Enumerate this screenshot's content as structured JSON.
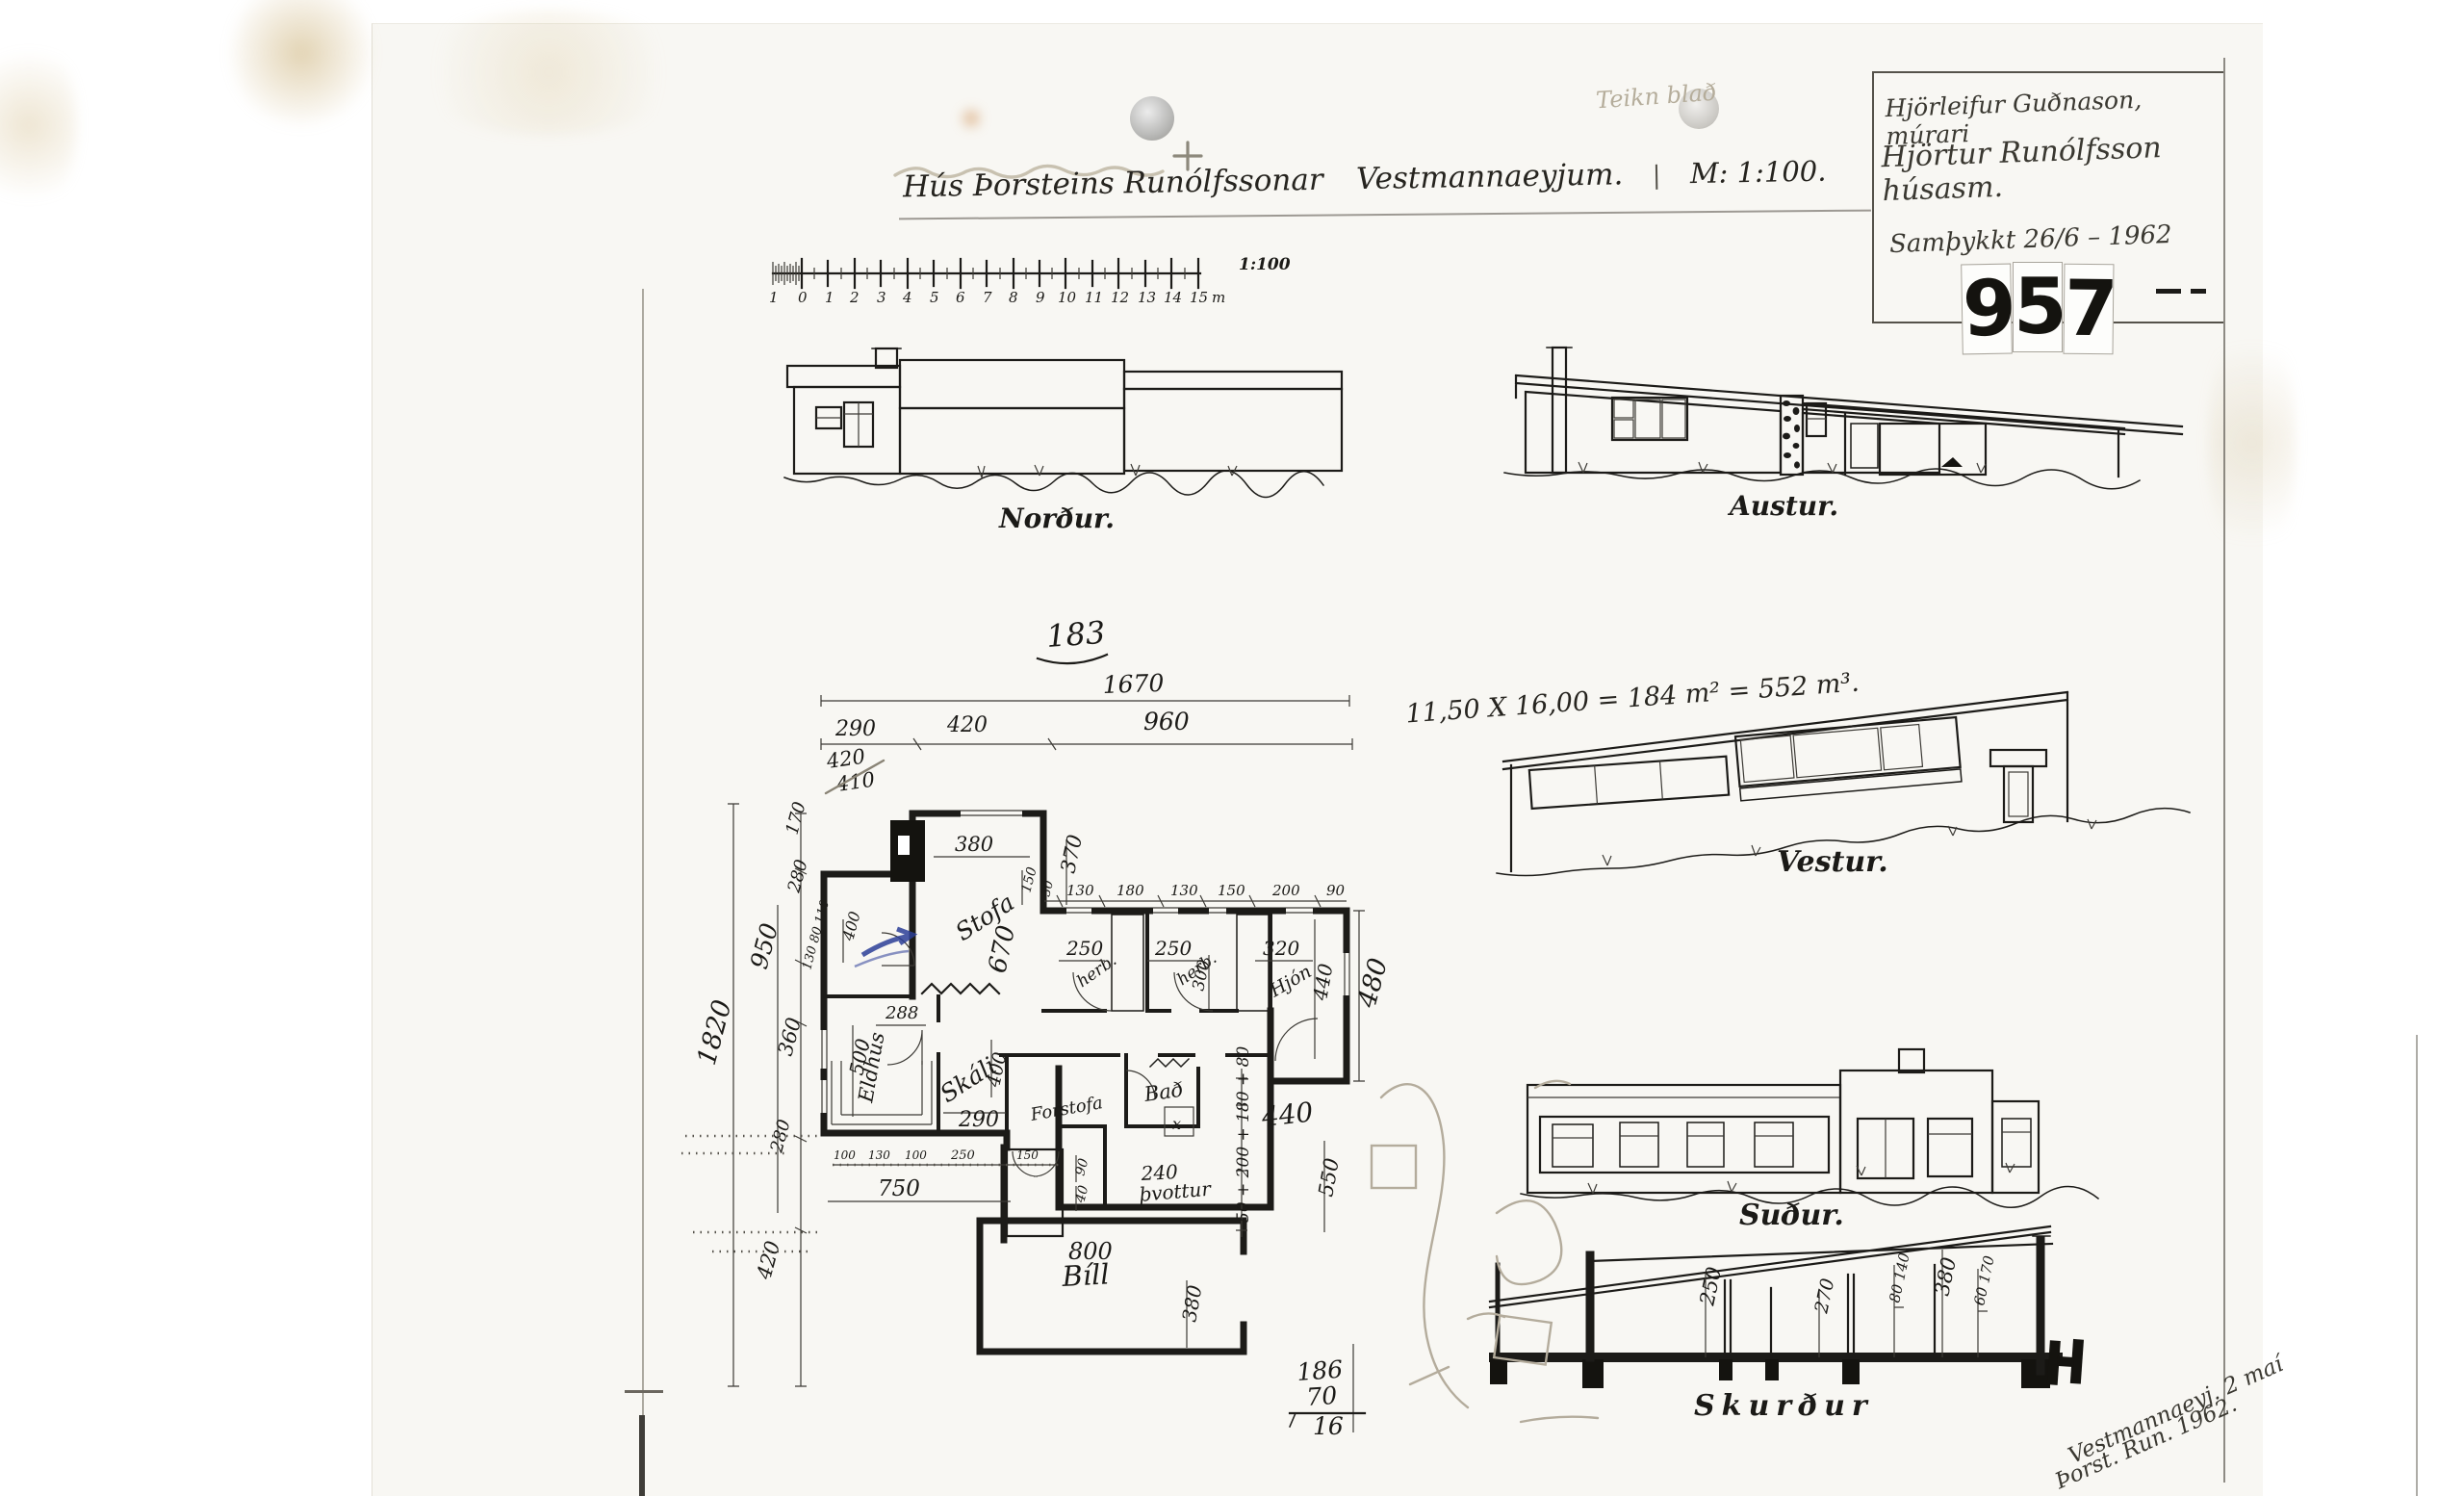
{
  "page": {
    "faded_label": "Teikn blað",
    "title": "Hús Þorsteins Runólfssonar",
    "location": "Vestmannaeyjum.",
    "sep": "|",
    "scale_note": "M: 1:100.",
    "calc": "11,50 X 16,00 = 184 m² = 552 m³.",
    "stamp": [
      "9",
      "5",
      "7"
    ],
    "titleblock": [
      "Hjörleifur Guðnason, múrari",
      "Hjörtur Runólfsson húsasm.",
      "Samþykkt 26/6 – 1962"
    ],
    "corner_note": [
      "Vestmannaeyj. 2 maí",
      "Þorst. Run. 1962."
    ],
    "sum_stack": [
      "186",
      "70",
      "16"
    ]
  },
  "scalebar": {
    "pre": "1",
    "ticks": [
      "0",
      "1",
      "2",
      "3",
      "4",
      "5",
      "6",
      "7",
      "8",
      "9",
      "10",
      "11",
      "12",
      "13",
      "14",
      "15"
    ],
    "unit": "m",
    "ratio": "1:100"
  },
  "elevations": {
    "north": "Norður.",
    "east": "Austur.",
    "west": "Vestur.",
    "south": "Suður.",
    "section": "Skurður"
  },
  "plan": {
    "number": "183",
    "rooms": {
      "stofa": "Stofa",
      "eldhus": "Eldhús",
      "skali": "Skáli",
      "forstofa": "Forstofa",
      "bad": "Bað",
      "thvottur": "þvottur",
      "herb_a": "herb.",
      "herb_b": "herb.",
      "hjon": "Hjón",
      "bill": "Bíll",
      "closet": "x"
    },
    "dims": {
      "w_total": "1670",
      "w_a": "290",
      "w_b": "420",
      "w_c": "960",
      "pencil_a": "420",
      "pencil_b": "410",
      "h_total": "1820",
      "v_170": "170",
      "v_280a": "280",
      "v_950": "950",
      "v_sub": "130 80 110",
      "v_360": "360",
      "v_280b": "280",
      "v_420": "420",
      "stofa_w": "380",
      "stofa_h": "670",
      "d370": "370",
      "d150": "150",
      "d400a": "400",
      "bed_chain": [
        "30",
        "130",
        "180",
        "130",
        "150",
        "200",
        "90"
      ],
      "herb1_w": "250",
      "herb2_w": "250",
      "herb2_d": "300",
      "hjon_w": "320",
      "hjon_h": "440",
      "right_h": "480",
      "eldhus_h": "500",
      "d288": "288",
      "skali_h": "400",
      "skali_w": "290",
      "bottom_chain": [
        "100",
        "130",
        "100",
        "250",
        "150"
      ],
      "d90": "90",
      "d40": "40",
      "d750": "750",
      "bath_chain": "50 + 200 + 180 + 80",
      "d240": "240",
      "d440": "440",
      "d550": "550",
      "garage_area": "800",
      "garage_w": "380"
    }
  },
  "section": {
    "dims": [
      "250",
      "270",
      "80 140",
      "380",
      "60 170"
    ]
  }
}
